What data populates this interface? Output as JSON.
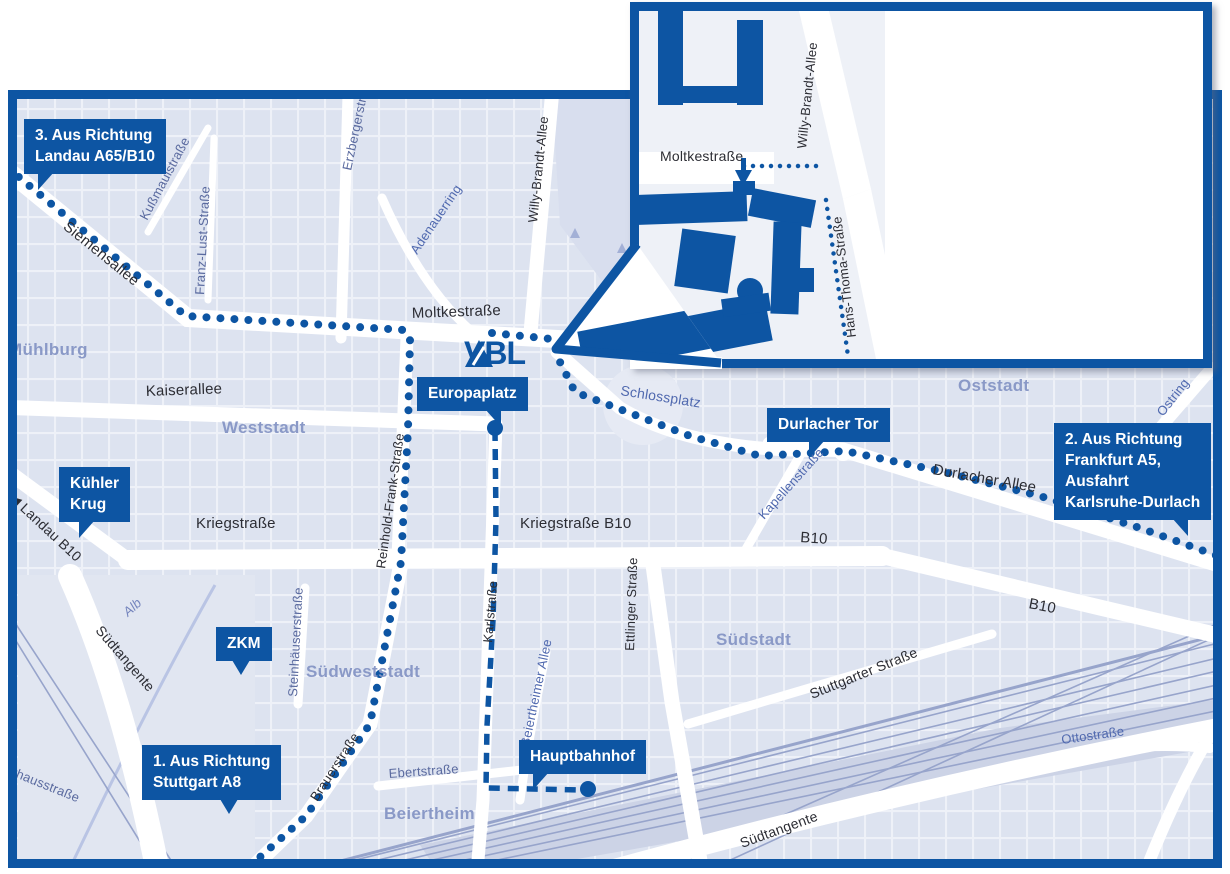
{
  "colors": {
    "accent": "#0d55a3",
    "map_bg": "#dde3f0",
    "park": "#d8deee",
    "district_text": "#8a99c7",
    "rail": "#97a4cb"
  },
  "logo": {
    "text": "VBL"
  },
  "inset": {
    "heading_line1": "Adresse für",
    "heading_line2": "Besuchende.",
    "address_line1": "Hans-Thoma-Str. 19",
    "address_line2": "76133 Karlsruhe",
    "streets": [
      {
        "text": "Moltkestraße",
        "x": 660,
        "y": 162,
        "rot": 0,
        "size": 14,
        "cls": "dark"
      },
      {
        "text": "Willy-Brandt-Allee",
        "x": 806,
        "y": 150,
        "rot": -84,
        "size": 13,
        "cls": "dark"
      },
      {
        "text": "Hans-Thoma-Straße",
        "x": 856,
        "y": 338,
        "rot": -97,
        "size": 13,
        "cls": "dark"
      }
    ]
  },
  "map": {
    "street_labels": [
      {
        "text": "Siemensallee",
        "x": 62,
        "y": 230,
        "rot": 39,
        "cls": "dark",
        "size": 15
      },
      {
        "text": "Kußmaulstraße",
        "x": 147,
        "y": 222,
        "rot": -62,
        "cls": "slate",
        "size": 13
      },
      {
        "text": "Franz-Lust-Straße",
        "x": 204,
        "y": 296,
        "rot": -87,
        "cls": "slate",
        "size": 13
      },
      {
        "text": "Erzbergerstraße",
        "x": 351,
        "y": 172,
        "rot": -78,
        "cls": "slate",
        "size": 13
      },
      {
        "text": "Adenauerring",
        "x": 417,
        "y": 256,
        "rot": -56,
        "cls": "blue",
        "size": 13
      },
      {
        "text": "Willy-Brandt-Allee",
        "x": 537,
        "y": 224,
        "rot": -84,
        "cls": "dark",
        "size": 13
      },
      {
        "text": "Moltkestraße",
        "x": 412,
        "y": 320,
        "rot": -2,
        "cls": "dark",
        "size": 15
      },
      {
        "text": "Kaiserallee",
        "x": 146,
        "y": 398,
        "rot": -2,
        "cls": "dark",
        "size": 15
      },
      {
        "text": "Schlossplatz",
        "x": 620,
        "y": 396,
        "rot": 9,
        "cls": "blue",
        "size": 14
      },
      {
        "text": "Durlacher Allee",
        "x": 932,
        "y": 476,
        "rot": 10,
        "cls": "dark",
        "size": 15
      },
      {
        "text": "Kapellenstraße",
        "x": 764,
        "y": 521,
        "rot": -48,
        "cls": "blue",
        "size": 13
      },
      {
        "text": "Ostring",
        "x": 1163,
        "y": 418,
        "rot": -52,
        "cls": "blue",
        "size": 13
      },
      {
        "text": "Kriegstraße",
        "x": 196,
        "y": 530,
        "rot": 0,
        "cls": "dark",
        "size": 15
      },
      {
        "text": "Kriegstraße B10",
        "x": 520,
        "y": 530,
        "rot": 0,
        "cls": "dark",
        "size": 15
      },
      {
        "text": "B10",
        "x": 800,
        "y": 544,
        "rot": 4,
        "cls": "dark",
        "size": 15
      },
      {
        "text": "B10",
        "x": 1028,
        "y": 610,
        "rot": 11,
        "cls": "dark",
        "size": 15
      },
      {
        "text": "◀ Landau B10",
        "x": 8,
        "y": 500,
        "rot": 43,
        "cls": "dark",
        "size": 14
      },
      {
        "text": "Reinhold-Frank-Straße",
        "x": 385,
        "y": 570,
        "rot": -82,
        "cls": "dark",
        "size": 13
      },
      {
        "text": "Karlstraße",
        "x": 492,
        "y": 644,
        "rot": -85,
        "cls": "dark",
        "size": 13
      },
      {
        "text": "Ettlinger Straße",
        "x": 634,
        "y": 652,
        "rot": -88,
        "cls": "dark",
        "size": 13
      },
      {
        "text": "Steinhäuserstraße",
        "x": 297,
        "y": 698,
        "rot": -87,
        "cls": "slate",
        "size": 13
      },
      {
        "text": "Brauerstraße",
        "x": 317,
        "y": 803,
        "rot": -57,
        "cls": "dark",
        "size": 13
      },
      {
        "text": "Ebertstraße",
        "x": 389,
        "y": 779,
        "rot": -4,
        "cls": "slate",
        "size": 13
      },
      {
        "text": "Beiertheimer Allee",
        "x": 529,
        "y": 748,
        "rot": -78,
        "cls": "blue",
        "size": 13
      },
      {
        "text": "Alb",
        "x": 128,
        "y": 618,
        "rot": -42,
        "cls": "blue-italic",
        "size": 13
      },
      {
        "text": "Pulverhausstraße",
        "x": -20,
        "y": 764,
        "rot": 22,
        "cls": "slate",
        "size": 13
      },
      {
        "text": "Stuttgarter Straße",
        "x": 812,
        "y": 700,
        "rot": -22,
        "cls": "dark",
        "size": 14
      },
      {
        "text": "Südtangente",
        "x": 95,
        "y": 632,
        "rot": 49,
        "cls": "dark",
        "size": 14
      },
      {
        "text": "Südtangente",
        "x": 742,
        "y": 849,
        "rot": -20,
        "cls": "dark",
        "size": 14
      },
      {
        "text": "Ottostraße",
        "x": 1062,
        "y": 745,
        "rot": -8,
        "cls": "blue",
        "size": 13
      }
    ],
    "district_labels": [
      {
        "text": "Mühlburg",
        "x": 8,
        "y": 340
      },
      {
        "text": "Weststadt",
        "x": 222,
        "y": 418
      },
      {
        "text": "Oststadt",
        "x": 958,
        "y": 376
      },
      {
        "text": "Südstadt",
        "x": 716,
        "y": 630
      },
      {
        "text": "Südweststadt",
        "x": 306,
        "y": 662
      },
      {
        "text": "Beiertheim",
        "x": 384,
        "y": 804
      }
    ],
    "markers": [
      {
        "id": "landau",
        "lines": [
          "3. Aus Richtung",
          "Landau A65/B10"
        ],
        "x": 24,
        "y": 119,
        "tail": "bl",
        "tx": 14
      },
      {
        "id": "kuehler-krug",
        "lines": [
          "Kühler",
          "Krug"
        ],
        "x": 59,
        "y": 467,
        "tail": "bl",
        "tx": 20
      },
      {
        "id": "zkm",
        "lines": [
          "ZKM"
        ],
        "x": 216,
        "y": 627,
        "tail": "bc",
        "tx": 16
      },
      {
        "id": "stuttgart",
        "lines": [
          "1. Aus Richtung",
          "Stuttgart A8"
        ],
        "x": 142,
        "y": 745,
        "tail": "bc",
        "tx": 78
      },
      {
        "id": "europaplatz",
        "lines": [
          "Europaplatz"
        ],
        "x": 417,
        "y": 377,
        "tail": "br",
        "tx": 68,
        "dot": {
          "x": 495,
          "y": 428
        }
      },
      {
        "id": "durlacher-tor",
        "lines": [
          "Durlacher Tor"
        ],
        "x": 767,
        "y": 408,
        "tail": "bl",
        "tx": 42
      },
      {
        "id": "frankfurt",
        "lines": [
          "2. Aus Richtung",
          "Frankfurt A5,",
          "Ausfahrt",
          "Karlsruhe-Durlach"
        ],
        "x": 1054,
        "y": 423,
        "tail": "br",
        "tx": 118
      },
      {
        "id": "hauptbahnhof",
        "lines": [
          "Hauptbahnhof"
        ],
        "x": 519,
        "y": 740,
        "tail": "bl",
        "tx": 14,
        "dot": {
          "x": 588,
          "y": 789
        }
      }
    ]
  }
}
